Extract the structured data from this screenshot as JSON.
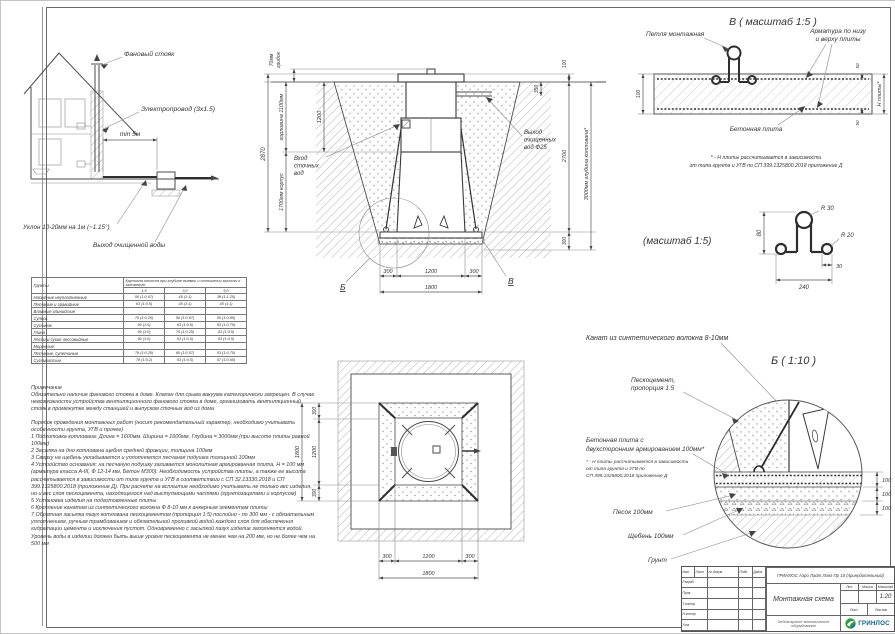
{
  "dims": {
    "d30": "30",
    "d50": "50",
    "d80": "80",
    "d100": "100",
    "d240": "240",
    "d300": "300",
    "d350": "350",
    "d1200": "1200",
    "d1800": "1800",
    "d2700": "2700",
    "d2870": "2870",
    "pit": "3000мм глубина котлована*",
    "neck": "горловина 1100мм",
    "body": "1700мм корпус",
    "cap1": "70мм",
    "cap2": "грибок",
    "r30": "R 30",
    "r20": "R 20"
  },
  "house": {
    "fan": "Фановый стояк",
    "wire": "Электропровод (3х1.5)",
    "min5": "min 5м",
    "slope": "Уклон 10-20мм на 1м (~1.15°)",
    "out": "Выход очищенной воды"
  },
  "cross": {
    "in1": "Вход",
    "in2": "сточных",
    "in3": "вод",
    "out1": "Выход",
    "out2": "очищенных",
    "out3": "вод Ф25",
    "mb": "Б",
    "mv": "В"
  },
  "det_v": {
    "title": "В ( масштаб 1:5 )",
    "loop": "Петля монтажная",
    "reb1": "Арматура по низу",
    "reb2": "и верху плиты",
    "slab": "Бетонная плита",
    "h": "Н плиты*",
    "n1": "* - Н плиты рассчитывается в зависимости",
    "n2": "от типа грунта и УГВ по СП 399.1325800.2018 приложение Д"
  },
  "det_p": {
    "title": "(масштаб 1:5)"
  },
  "det_b": {
    "rope": "Канат из синтетического волокна 8-10мм",
    "title": "Б ( 1:10 )",
    "sc1": "Пескоцемент,",
    "sc2": "пропорция 1:5",
    "sl1": "Бетонная плита с",
    "sl2": "двухсторонним армированием 100мм*",
    "n1": "* - Н плиты рассчитывается в зависимости",
    "n2": "от типа грунта и УГВ по",
    "n3": "СП 399.1325800.2018 приложение Д",
    "sand": "Песок 100мм",
    "grav": "Щебень 100мм",
    "soil": "Грунт"
  },
  "soil_table": {
    "col_soil": "Грунты",
    "col_slope": "Крутизна откосов при глубине выемки и отношении высоты к заложению",
    "depths": [
      "1,5",
      "3,0",
      "5,0"
    ],
    "rows": [
      {
        "name": "Насыпные неуплотненные",
        "c1": "56 (1:0,67)",
        "c2": "45 (1:1)",
        "c3": "38 (1:1,25)"
      },
      {
        "name": "Песчаные и гравийные",
        "c1": "63 (1:0,5)",
        "c2": "45 (1:1)",
        "c3": "45 (1:1)"
      },
      {
        "name": "Влажные глинистые",
        "c1": "",
        "c2": "",
        "c3": ""
      },
      {
        "name": "Супесь",
        "c1": "76 (1:0,25)",
        "c2": "56 (1:0,67)",
        "c3": "50 (1:0,85)"
      },
      {
        "name": "Суглинок",
        "c1": "90 (1:0)",
        "c2": "63 (1:0,5)",
        "c3": "53 (1:0,75)"
      },
      {
        "name": "Глина",
        "c1": "90 (1:0)",
        "c2": "76 (1:0,25)",
        "c3": "63 (1:0,5)"
      },
      {
        "name": "Лессы и сухие лессовидные",
        "c1": "90 (1:0)",
        "c2": "63 (1:0,5)",
        "c3": "63 (1:0,5)"
      },
      {
        "name": "Моренные:",
        "c1": "",
        "c2": "",
        "c3": ""
      },
      {
        "name": "Песчаные, супесчаные",
        "c1": "76 (1:0,25)",
        "c2": "60 (1:0,57)",
        "c3": "53 (1:0,75)"
      },
      {
        "name": "Суглинистые",
        "c1": "78 (1:0,2)",
        "c2": "63 (1:0,5)",
        "c3": "57 (1:0,65)"
      }
    ]
  },
  "notes": {
    "title": "Примечание",
    "p1": "Обязательно наличие фанового стояка в доме. Клапан для срыва вакуума категорически запрещен. В случае невозможности устройства вентиляционного фанового стояка в доме, организовать вентиляционный стояк в промежутке между станцией и выпуском сточных вод из дома",
    "order": "Порядок проведения монтажных работ (носит рекомендательный характер, необходимо учитывать особенности грунта, УГВ и прочее)",
    "steps": [
      "1 Подготовка котлована: Длина = 1600мм. Ширина = 1600мм. Глубина = 3000мм (при высоте плиты равной 100мм)",
      "2 Засыпка на дно котлована щебня средней фракции, толщина 100мм",
      "3 Сверху на щебень укладывается и уплотняется песчаная подушка толщиной 100мм",
      "4 Устройство основания: на песчаную подушку заливается монолитная армированная плита, Н = 100 мм (арматура класса А-III, Ф 12-14 мм, Бетон М300). Необходимость устройства плиты, а также ее высота рассчитывается в зависимости от типа грунта и УГВ в соответствии с СП 32.13330.2018 и СП 399.1325800.2018 (приложение Д). При расчете на всплытие необходимо учитывать не только вес изделия, но и вес слоя пескоцемента, находящегося над выступающими частями (грунтозацепами и корпусом)",
      "5 Установка изделия на подготовленные плиты",
      "6 Крепление канатом из синтетического волокна Ф 8-10 мм к анкерным элементам плиты",
      "7 Обратная засыпка пазух котлована пескоцементом (пропорция 1:5) послойно - по 300 мм - с обязательным уплотнением, ручным трамбованием и обязательной проливкой водой каждого слоя для обеспечения гидратации цемента и исключения пустот. Одновременно с засыпкой пазух изделие заполняется водой. Уровень воды в изделии должен быть выше уровня пескоцемента не менее чем на 200 мм, но не более чем на 500 мм"
    ]
  },
  "tb": {
    "product": "ГРИНЛОС Аэро Лайт Лонг Пр 10 (принудительный)",
    "doc": "Монтажная схема",
    "scale": "1:20",
    "company": "Чебоксарское экологическое оборудование",
    "brand": "ГРИНЛОС",
    "h_izm": "Изм.",
    "h_list": "Лист",
    "h_doc": "№ докум.",
    "h_sign": "Подп.",
    "h_date": "Дата",
    "r1": "Разраб.",
    "r2": "Пров.",
    "r3": "Т.контр.",
    "r4": "Н.контр.",
    "r5": "Утв.",
    "lit": "Лит.",
    "mass": "Масса",
    "masht": "Масштаб",
    "sheet": "Лист",
    "sheets": "Листов"
  },
  "colors": {
    "line": "#4a4a4a",
    "hatch": "#b5b5b5",
    "accent_green": "#2f9e44",
    "brand_blue": "#0e5f8a"
  }
}
